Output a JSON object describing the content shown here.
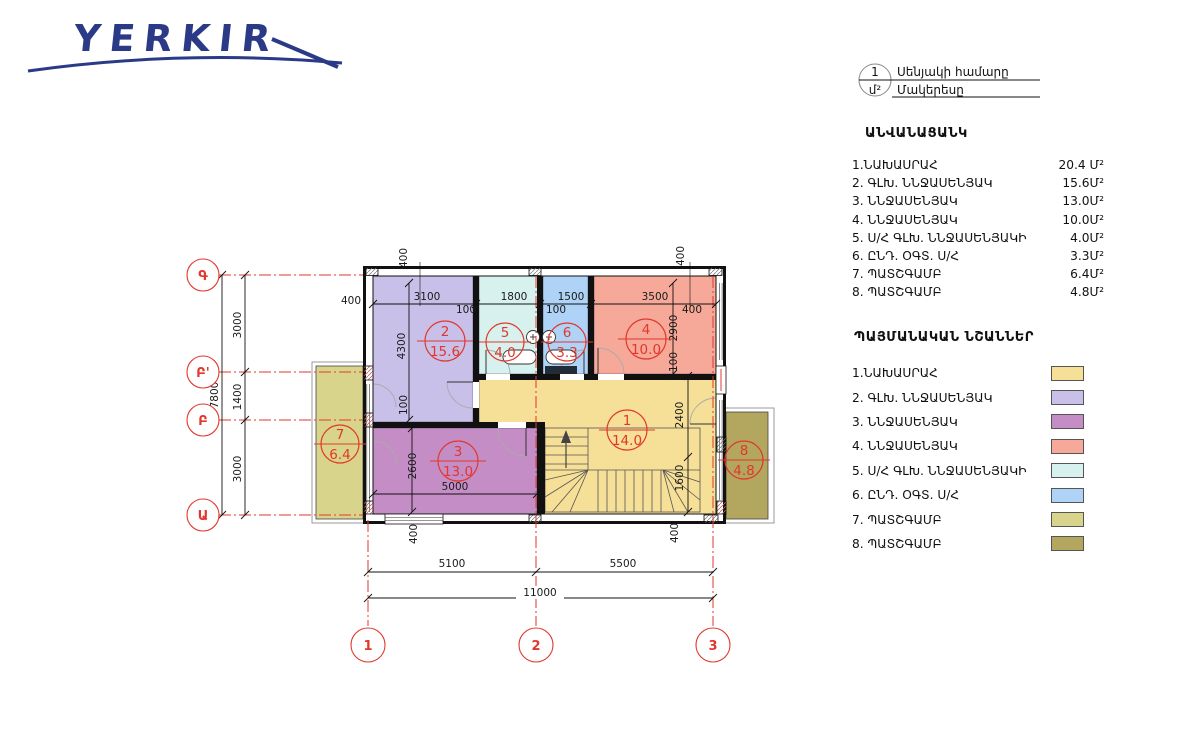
{
  "logo": {
    "text": "YERKIR"
  },
  "key": {
    "number": "1",
    "unit": "մ²",
    "row1": "Սենյակի համարը",
    "row2": "Մակերեսը"
  },
  "room_list": {
    "title": "ԱՆՎԱՆԱՑԱՆԿ",
    "items": [
      {
        "label": "1.ՆԱԽԱՍՐԱՀ",
        "area": "20.4 Մ²"
      },
      {
        "label": "2. ԳԼԽ. ՆՆՋԱՍԵՆՅԱԿ",
        "area": "15.6Մ²"
      },
      {
        "label": "3. ՆՆՋԱՍԵՆՅԱԿ",
        "area": "13.0Մ²"
      },
      {
        "label": "4. ՆՆՋԱՍԵՆՅԱԿ",
        "area": "10.0Մ²"
      },
      {
        "label": "5. Ս/Հ ԳԼԽ. ՆՆՋԱՍԵՆՅԱԿԻ",
        "area": "4.0Մ²"
      },
      {
        "label": "6. ԸՆԴ. ՕԳՏ. Ս/Հ",
        "area": "3.3Մ²"
      },
      {
        "label": "7. ՊԱՏՇԳԱՄԲ",
        "area": "6.4Մ²"
      },
      {
        "label": "8. ՊԱՏՇԳԱՄԲ",
        "area": "4.8Մ²"
      }
    ]
  },
  "legend": {
    "title": "ՊԱՅՄԱՆԱԿԱՆ ՆՇԱՆՆԵՐ",
    "items": [
      {
        "label": "1.ՆԱԽԱՍՐԱՀ",
        "color": "#F6DF97"
      },
      {
        "label": "2. ԳԼԽ. ՆՆՋԱՍԵՆՅԱԿ",
        "color": "#C8C0E8"
      },
      {
        "label": "3. ՆՆՋԱՍԵՆՅԱԿ",
        "color": "#C58DC6"
      },
      {
        "label": "4. ՆՆՋԱՍԵՆՅԱԿ",
        "color": "#F6A998"
      },
      {
        "label": "5. Ս/Հ ԳԼԽ. ՆՆՋԱՍԵՆՅԱԿԻ",
        "color": "#D7F2EE"
      },
      {
        "label": "6. ԸՆԴ. ՕԳՏ. Ս/Հ",
        "color": "#AED3F6"
      },
      {
        "label": "7. ՊԱՏՇԳԱՄԲ",
        "color": "#D9D48C"
      },
      {
        "label": "8. ՊԱՏՇԳԱՄԲ",
        "color": "#B3A65E"
      }
    ]
  },
  "plan": {
    "rooms": [
      {
        "number": "1",
        "area": "14.0"
      },
      {
        "number": "2",
        "area": "15.6"
      },
      {
        "number": "3",
        "area": "13.0"
      },
      {
        "number": "4",
        "area": "10.0"
      },
      {
        "number": "5",
        "area": "4.0"
      },
      {
        "number": "6",
        "area": "3.3"
      },
      {
        "number": "7",
        "area": "6.4"
      },
      {
        "number": "8",
        "area": "4.8"
      }
    ],
    "grid": {
      "cols": [
        "1",
        "2",
        "3"
      ],
      "rows": [
        "Գ",
        "Բ'",
        "Բ",
        "Ա"
      ]
    },
    "dims": {
      "d100": "100",
      "d400": "400",
      "d1400": "1400",
      "d1500": "1500",
      "d1600": "1600",
      "d1800": "1800",
      "d2400": "2400",
      "d2600": "2600",
      "d2900": "2900",
      "d3000": "3000",
      "d3100": "3100",
      "d3500": "3500",
      "d4300": "4300",
      "d5000": "5000",
      "d5100": "5100",
      "d5500": "5500",
      "d7800": "7800",
      "d11000": "11000"
    }
  },
  "colors": {
    "accent_red": "#E2372C",
    "logo_navy": "#2B3A86",
    "line": "#111111"
  }
}
